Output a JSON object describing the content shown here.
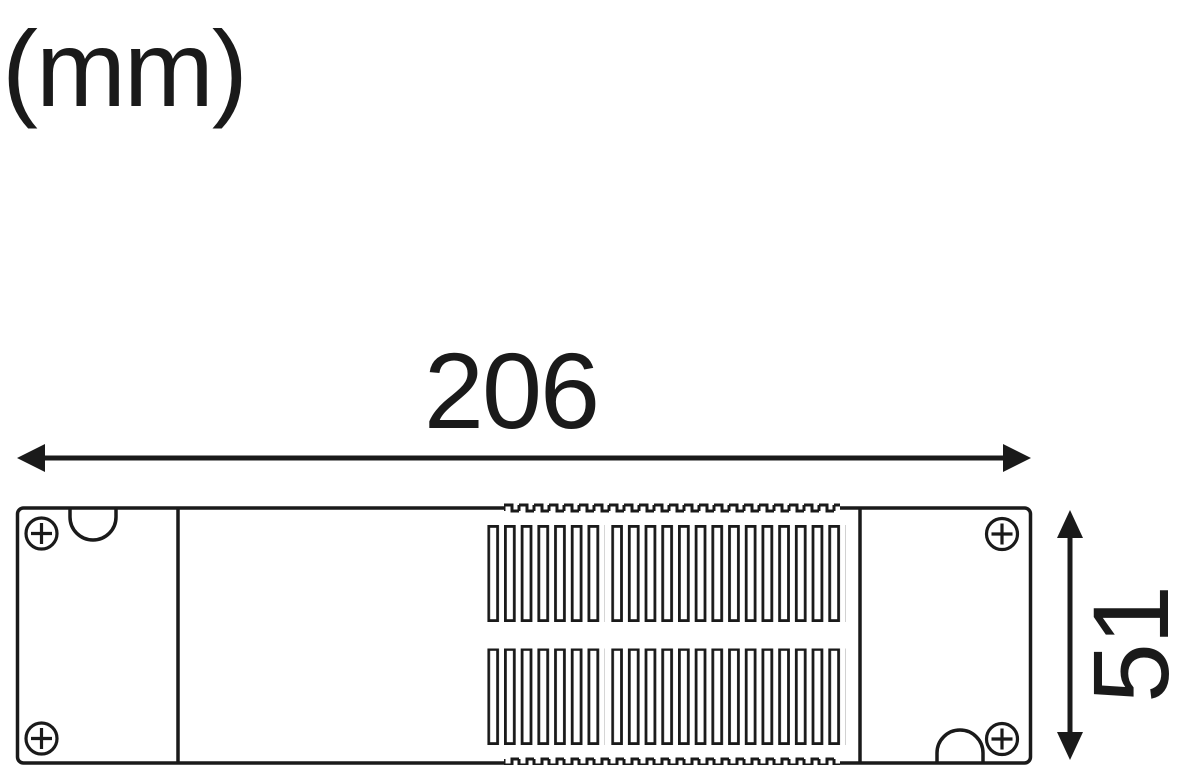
{
  "drawing": {
    "unit_label": "(mm)",
    "width_dimension": "206",
    "height_dimension": "51",
    "device": {
      "corner_screws": 4,
      "vent_rows": 2,
      "vent_slots_per_row": 21,
      "vent_slot_groups": [
        7,
        14
      ],
      "cable_notches": 2
    },
    "colors": {
      "line": "#1a1a1a",
      "background": "#ffffff"
    }
  }
}
